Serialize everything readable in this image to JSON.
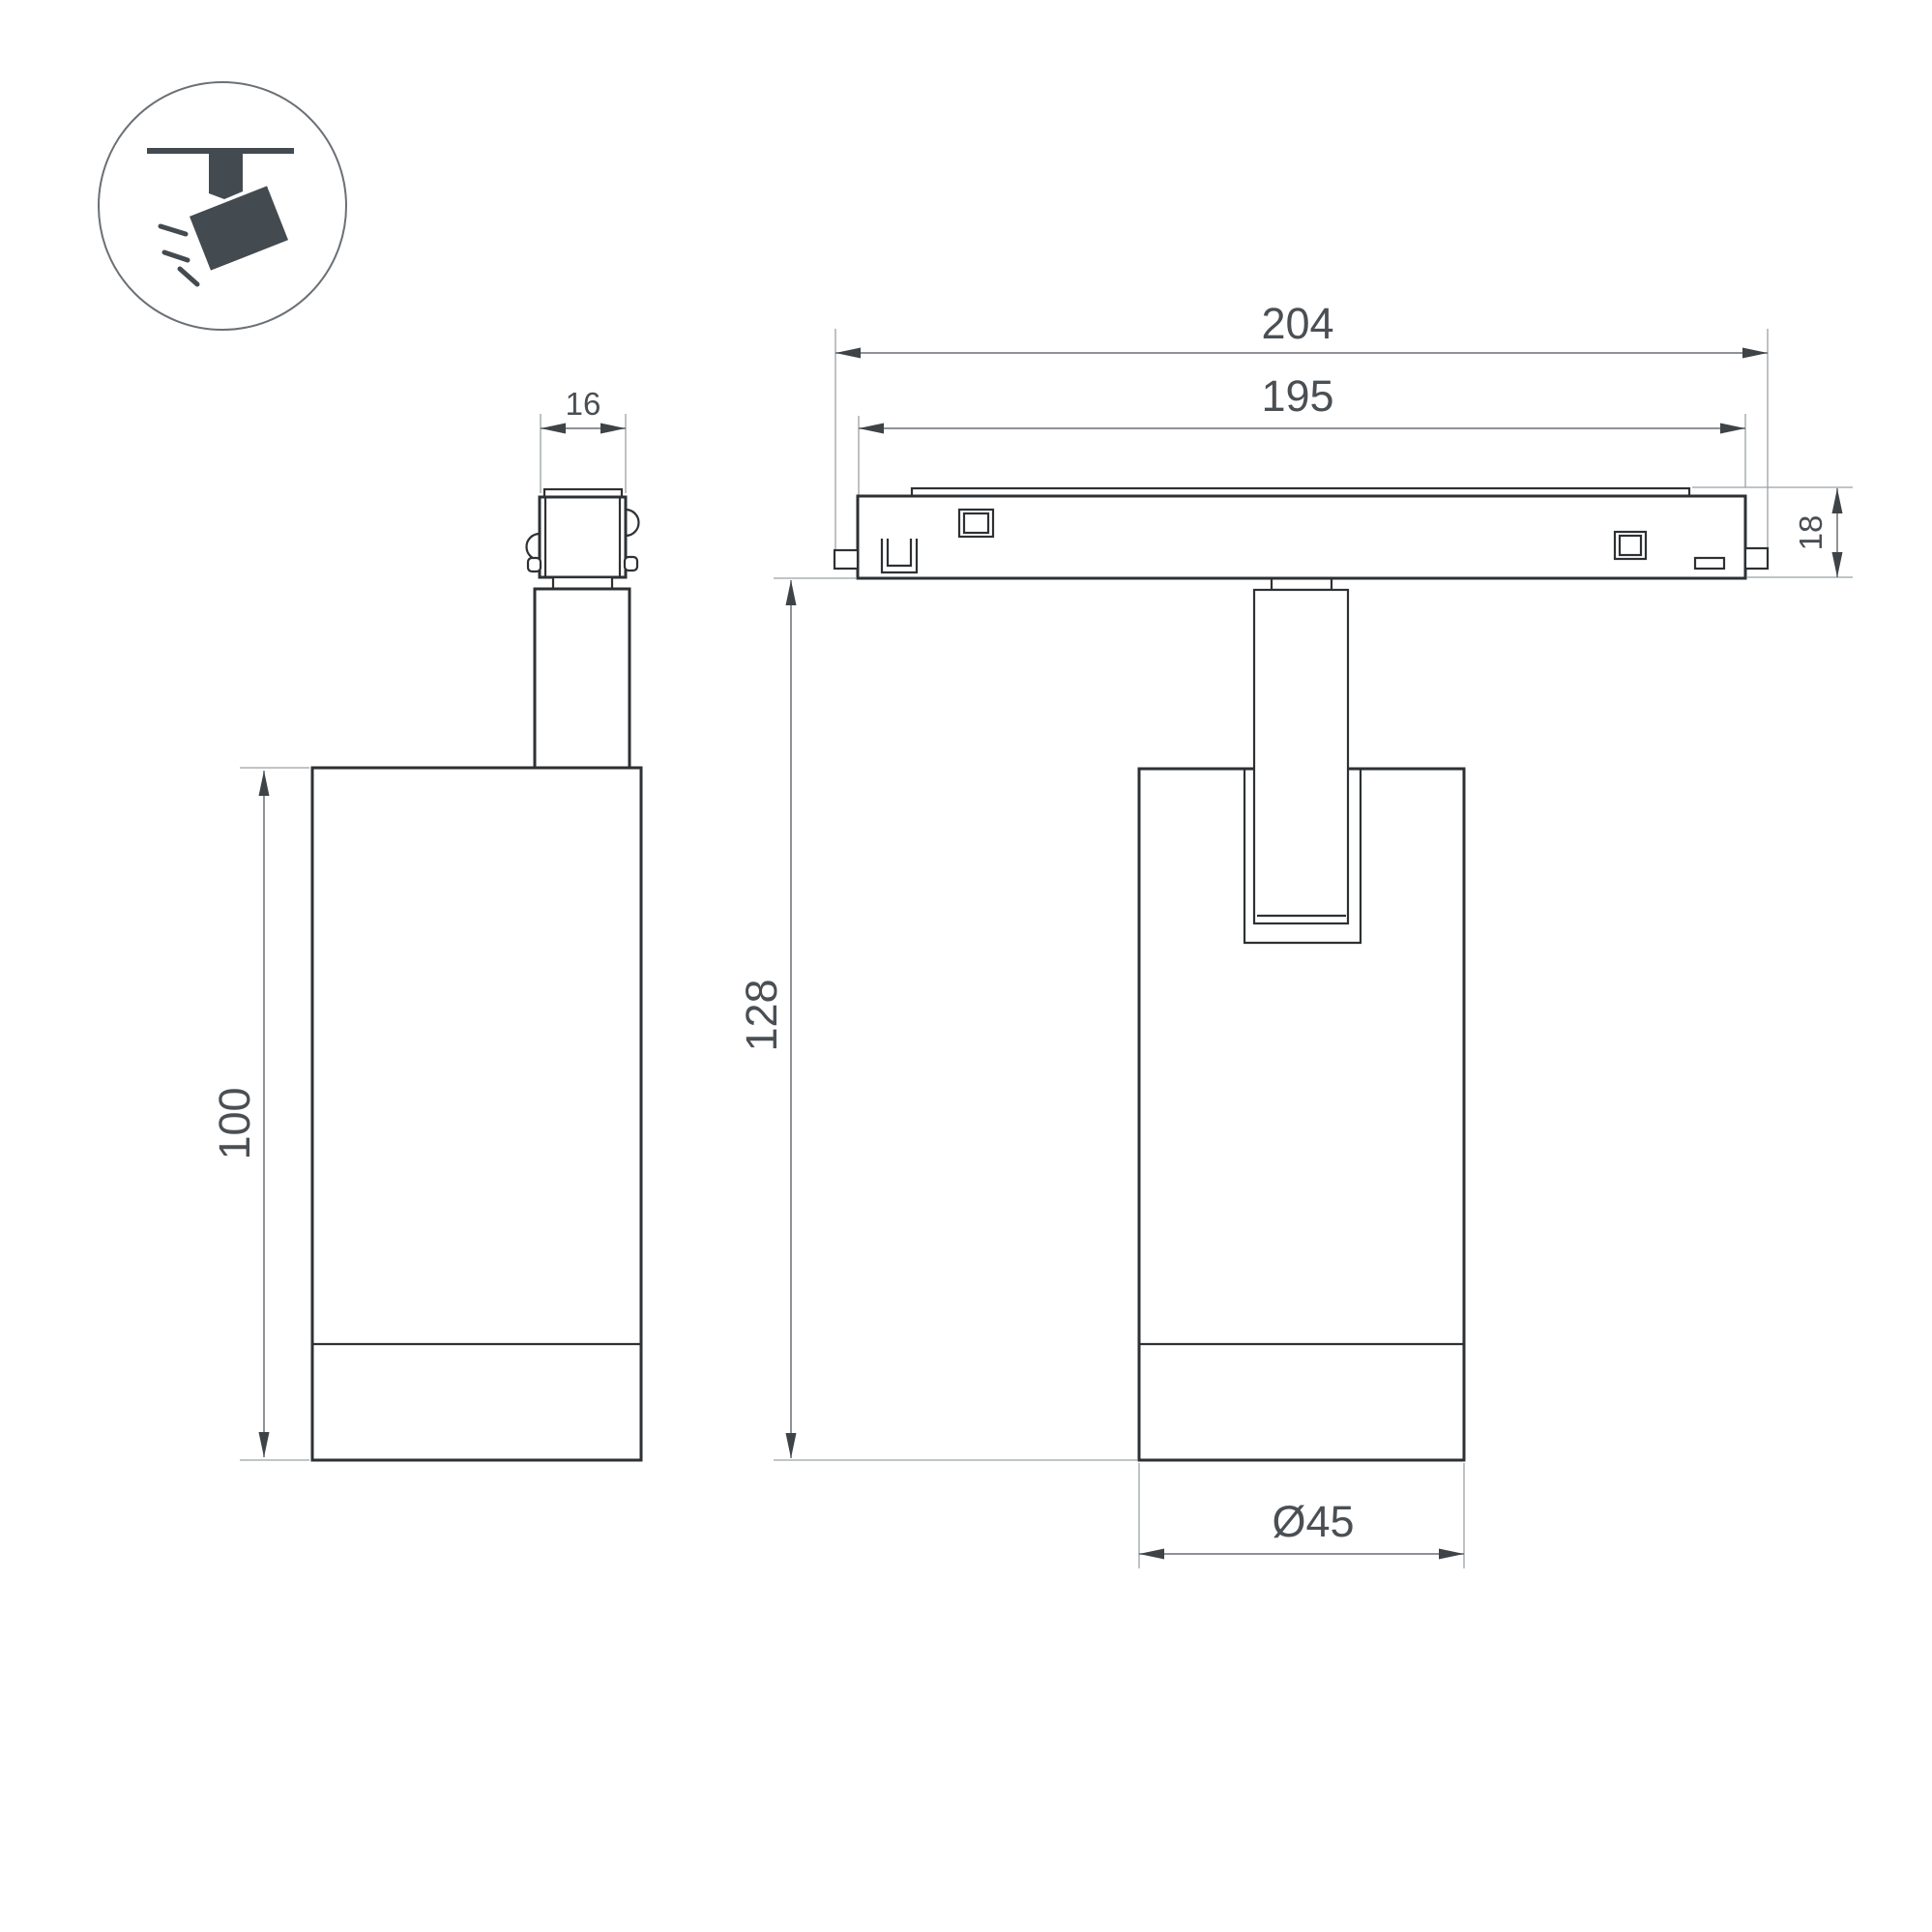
{
  "title": "Track spotlight luminaire dimension drawing",
  "colors": {
    "object_line": "#2d3134",
    "dimension_line": "#6a6f73",
    "extension_line": "#9aa0a4",
    "arrow": "#3e4347",
    "text": "#4a4f54",
    "icon": "#434a50",
    "background": "#ffffff"
  },
  "icon": {
    "label": "ceiling track spotlight pictogram"
  },
  "side_view": {
    "dim_connector_width": "16",
    "dim_body_height": "100"
  },
  "front_view": {
    "dim_overall_length": "204",
    "dim_track_length": "195",
    "dim_track_height": "18",
    "dim_total_height": "128",
    "dim_body_diameter": "Ø45"
  }
}
